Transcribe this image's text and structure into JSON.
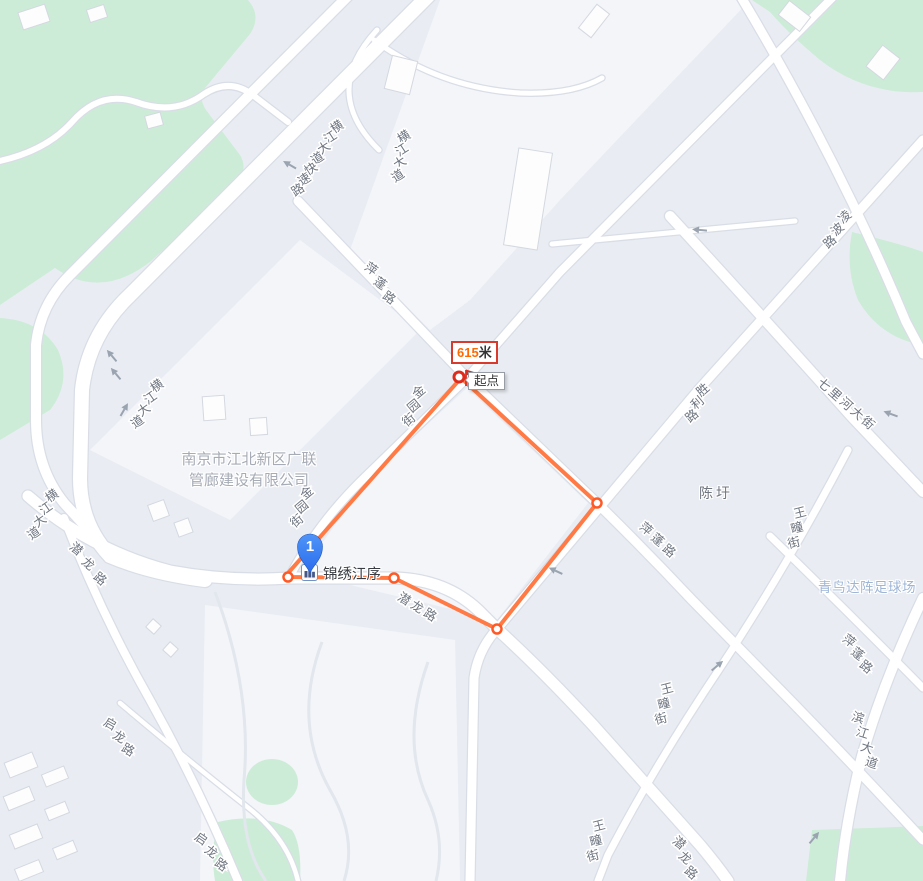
{
  "measure": {
    "distance_value": "615",
    "distance_unit": "米",
    "start_label": "起点",
    "route_points": [
      [
        461,
        378
      ],
      [
        289,
        572
      ],
      [
        288,
        577
      ],
      [
        394,
        578
      ],
      [
        497,
        629
      ],
      [
        597,
        503
      ],
      [
        461,
        378
      ]
    ],
    "vertex_points": [
      [
        288,
        577
      ],
      [
        394,
        578
      ],
      [
        497,
        629
      ],
      [
        597,
        503
      ]
    ],
    "start_point": [
      459,
      377
    ]
  },
  "marker": {
    "number": "1",
    "label": "锦绣江序"
  },
  "company": {
    "lines": [
      "南京市江北新区广联",
      "管廊建设有限公司"
    ]
  },
  "poi_labels": [
    {
      "text": "陈圩"
    },
    {
      "text": "青鸟达阵足球场"
    }
  ],
  "road_labels": [
    {
      "text": "横江大道快速路",
      "x": 337,
      "y": 127,
      "dx": -6.5,
      "dy": 10.5,
      "rot": -33
    },
    {
      "text": "横江大道",
      "x": 404,
      "y": 137,
      "dx": -2,
      "dy": 13,
      "rot": -33
    },
    {
      "text": "横江大道",
      "x": 157,
      "y": 386,
      "dx": -6.5,
      "dy": 12,
      "rot": -35
    },
    {
      "text": "横江大道",
      "x": 52,
      "y": 496,
      "dx": -6,
      "dy": 12.5,
      "rot": -35
    },
    {
      "text": "潜龙路",
      "x": 76,
      "y": 549,
      "dx": 12,
      "dy": 15,
      "rot": 40
    },
    {
      "text": "启龙路",
      "x": 110,
      "y": 724,
      "dx": 9,
      "dy": 13,
      "rot": 30
    },
    {
      "text": "启龙路",
      "x": 201,
      "y": 839,
      "dx": 10,
      "dy": 13,
      "rot": 35
    },
    {
      "text": "萍蓬路",
      "x": 371,
      "y": 269,
      "dx": 9,
      "dy": 14.5,
      "rot": 35
    },
    {
      "text": "金园街",
      "x": 419,
      "y": 392,
      "dx": -5,
      "dy": 14,
      "rot": -40
    },
    {
      "text": "金园街",
      "x": 307,
      "y": 493,
      "dx": -5,
      "dy": 14,
      "rot": -40
    },
    {
      "text": "胜利路",
      "x": 703,
      "y": 390,
      "dx": -5.5,
      "dy": 13,
      "rot": -40
    },
    {
      "text": "七里河大街",
      "x": 824,
      "y": 385,
      "dx": 11,
      "dy": 9.5,
      "rot": 42
    },
    {
      "text": "凌波路",
      "x": 845,
      "y": 217,
      "dx": -7.5,
      "dy": 12.5,
      "rot": -42
    },
    {
      "text": "萍蓬路",
      "x": 646,
      "y": 529,
      "dx": 11.5,
      "dy": 11,
      "rot": 40
    },
    {
      "text": "王疃街",
      "x": 800,
      "y": 513,
      "dx": -3,
      "dy": 15,
      "rot": -14
    },
    {
      "text": "王疃街",
      "x": 667,
      "y": 689,
      "dx": -3,
      "dy": 15,
      "rot": -14
    },
    {
      "text": "王疃街",
      "x": 599,
      "y": 826,
      "dx": -3,
      "dy": 15,
      "rot": -14
    },
    {
      "text": "潜龙路",
      "x": 404,
      "y": 599,
      "dx": 13,
      "dy": 8,
      "rot": 32
    },
    {
      "text": "潜龙路",
      "x": 679,
      "y": 843,
      "dx": 6,
      "dy": 15,
      "rot": 40
    },
    {
      "text": "萍蓬路",
      "x": 849,
      "y": 641,
      "dx": 8.5,
      "dy": 13,
      "rot": 38
    },
    {
      "text": "滨江大道",
      "x": 858,
      "y": 718,
      "dx": 4.5,
      "dy": 15,
      "rot": 18
    }
  ],
  "arrows": [
    {
      "x": 290,
      "y": 165,
      "rot": 210
    },
    {
      "x": 112,
      "y": 356,
      "rot": 230
    },
    {
      "x": 116,
      "y": 374,
      "rot": 230
    },
    {
      "x": 124,
      "y": 410,
      "rot": -60
    },
    {
      "x": 891,
      "y": 414,
      "rot": 200
    },
    {
      "x": 700,
      "y": 230,
      "rot": 185
    },
    {
      "x": 556,
      "y": 571,
      "rot": 205
    },
    {
      "x": 717,
      "y": 666,
      "rot": -40
    },
    {
      "x": 814,
      "y": 838,
      "rot": -50
    }
  ],
  "icons": {
    "start_flag": "start-flag-icon",
    "poi_building": "residence-icon",
    "direction": "road-direction-arrow"
  },
  "colors": {
    "route": "#ff7a45",
    "vertex_ring": "#ff5a26",
    "start_ring": "#dd2b1c",
    "badge_border": "#d83a2c",
    "badge_value": "#ff6a00",
    "park": "#cdecd7",
    "road": "#ffffff",
    "road_casing": "#d9dde6",
    "background": "#e9edf3",
    "pin": "#3b82f6",
    "road_label": "#6e7580",
    "arrow": "#9aa3b0"
  }
}
